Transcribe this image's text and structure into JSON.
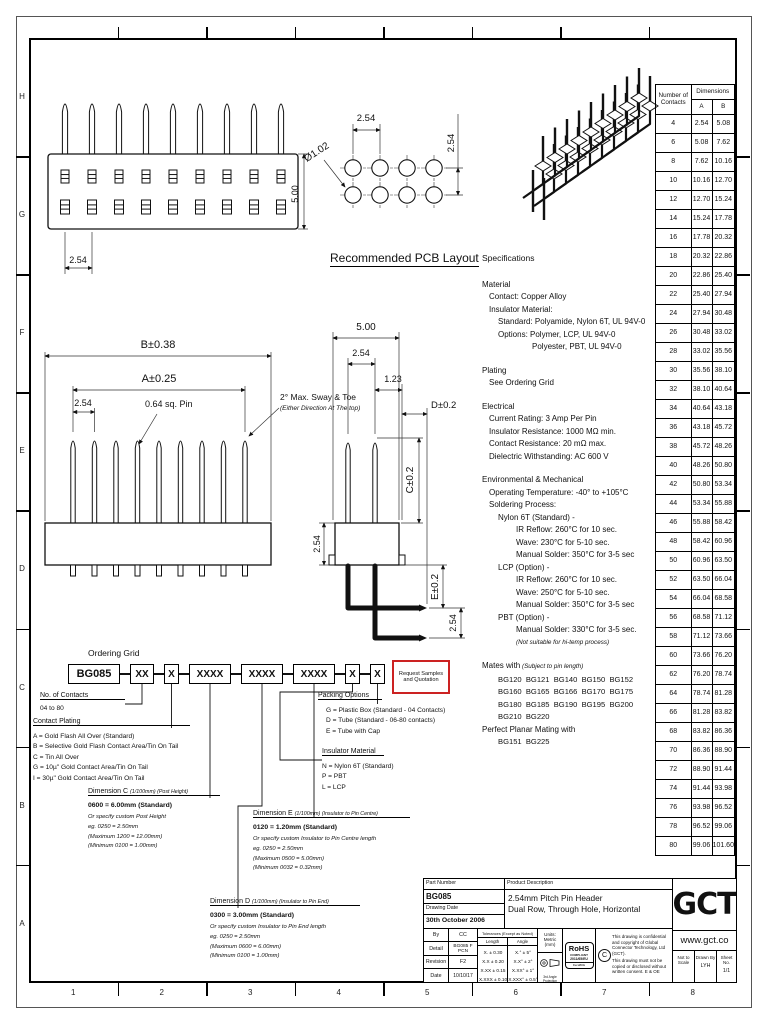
{
  "colors": {
    "paper": "#ffffff",
    "ink": "#111111",
    "accent_red": "#cc2222"
  },
  "sheet_frame": {
    "row_labels": [
      "H",
      "G",
      "F",
      "E",
      "D",
      "C",
      "B",
      "A"
    ],
    "col_labels": [
      "1",
      "2",
      "3",
      "4",
      "5",
      "6",
      "7",
      "8"
    ]
  },
  "front_view": {
    "pitch": "2.54",
    "height": "5.00"
  },
  "pcb_layout": {
    "title": "Recommended PCB Layout",
    "pitch_h": "2.54",
    "pitch_v": "2.54",
    "hole_dia": "Ø1.02"
  },
  "side_view": {
    "dim_b": "B±0.38",
    "dim_a": "A±0.25",
    "pitch": "2.54",
    "pin_label": "0.64 sq. Pin",
    "sway_line1": "2° Max. Sway & Toe",
    "sway_line2": "(Either Direction At The top)",
    "dim_500": "5.00",
    "dim_254_top": "2.54",
    "dim_123": "1.23",
    "dim_d": "D±0.2",
    "dim_c": "C±0.2",
    "dim_e": "E±0.2",
    "dim_254_left": "2.54",
    "dim_254_bottom": "2.54"
  },
  "contacts_table": {
    "header_contacts": "Number of Contacts",
    "header_dimensions": "Dimensions",
    "col_a": "A",
    "col_b": "B",
    "rows": [
      [
        "4",
        "2.54",
        "5.08"
      ],
      [
        "6",
        "5.08",
        "7.62"
      ],
      [
        "8",
        "7.62",
        "10.16"
      ],
      [
        "10",
        "10.16",
        "12.70"
      ],
      [
        "12",
        "12.70",
        "15.24"
      ],
      [
        "14",
        "15.24",
        "17.78"
      ],
      [
        "16",
        "17.78",
        "20.32"
      ],
      [
        "18",
        "20.32",
        "22.86"
      ],
      [
        "20",
        "22.86",
        "25.40"
      ],
      [
        "22",
        "25.40",
        "27.94"
      ],
      [
        "24",
        "27.94",
        "30.48"
      ],
      [
        "26",
        "30.48",
        "33.02"
      ],
      [
        "28",
        "33.02",
        "35.56"
      ],
      [
        "30",
        "35.56",
        "38.10"
      ],
      [
        "32",
        "38.10",
        "40.64"
      ],
      [
        "34",
        "40.64",
        "43.18"
      ],
      [
        "36",
        "43.18",
        "45.72"
      ],
      [
        "38",
        "45.72",
        "48.26"
      ],
      [
        "40",
        "48.26",
        "50.80"
      ],
      [
        "42",
        "50.80",
        "53.34"
      ],
      [
        "44",
        "53.34",
        "55.88"
      ],
      [
        "46",
        "55.88",
        "58.42"
      ],
      [
        "48",
        "58.42",
        "60.96"
      ],
      [
        "50",
        "60.96",
        "63.50"
      ],
      [
        "52",
        "63.50",
        "66.04"
      ],
      [
        "54",
        "66.04",
        "68.58"
      ],
      [
        "56",
        "68.58",
        "71.12"
      ],
      [
        "58",
        "71.12",
        "73.66"
      ],
      [
        "60",
        "73.66",
        "76.20"
      ],
      [
        "62",
        "76.20",
        "78.74"
      ],
      [
        "64",
        "78.74",
        "81.28"
      ],
      [
        "66",
        "81.28",
        "83.82"
      ],
      [
        "68",
        "83.82",
        "86.36"
      ],
      [
        "70",
        "86.36",
        "88.90"
      ],
      [
        "72",
        "88.90",
        "91.44"
      ],
      [
        "74",
        "91.44",
        "93.98"
      ],
      [
        "76",
        "93.98",
        "96.52"
      ],
      [
        "78",
        "96.52",
        "99.06"
      ],
      [
        "80",
        "99.06",
        "101.60"
      ]
    ]
  },
  "specifications": {
    "title": "Specifications",
    "lines": [
      {
        "t": "Material",
        "i": 0
      },
      {
        "t": "Contact: Copper Alloy",
        "i": 1
      },
      {
        "t": "Insulator Material:",
        "i": 1
      },
      {
        "t": "Standard: Polyamide, Nylon 6T, UL 94V-0",
        "i": 2
      },
      {
        "t": "Options: Polymer, LCP, UL 94V-0",
        "i": 2
      },
      {
        "t": "Polyester, PBT, UL 94V-0",
        "i": 4
      },
      {
        "gap": true
      },
      {
        "t": "Plating",
        "i": 0
      },
      {
        "t": "See Ordering Grid",
        "i": 1
      },
      {
        "gap": true
      },
      {
        "t": "Electrical",
        "i": 0
      },
      {
        "t": "Current Rating: 3 Amp Per Pin",
        "i": 1
      },
      {
        "t": "Insulator Resistance: 1000 MΩ min.",
        "i": 1
      },
      {
        "t": "Contact Resistance: 20 mΩ max.",
        "i": 1
      },
      {
        "t": "Dielectric Withstanding: AC 600 V",
        "i": 1
      },
      {
        "gap": true
      },
      {
        "t": "Environmental & Mechanical",
        "i": 0
      },
      {
        "t": "Operating Temperature: -40° to +105°C",
        "i": 1
      },
      {
        "t": "Soldering Process:",
        "i": 1
      },
      {
        "t": "Nylon 6T (Standard) -",
        "i": 2
      },
      {
        "t": "IR Reflow: 260°C for 10 sec.",
        "i": 3
      },
      {
        "t": "Wave: 230°C for 5-10 sec.",
        "i": 3
      },
      {
        "t": "Manual Solder: 350°C for 3-5 sec",
        "i": 3
      },
      {
        "t": "LCP (Option) -",
        "i": 2
      },
      {
        "t": "IR Reflow: 260°C for 10 sec.",
        "i": 3
      },
      {
        "t": "Wave: 250°C for 5-10 sec.",
        "i": 3
      },
      {
        "t": "Manual Solder: 350°C for 3-5 sec",
        "i": 3
      },
      {
        "t": "PBT (Option) -",
        "i": 2
      },
      {
        "t": "Manual Solder: 330°C for 3-5 sec.",
        "i": 3
      },
      {
        "t": "(Not suitable for hi-temp process)",
        "i": 3,
        "s": 1
      },
      {
        "gap": true
      },
      {
        "t": "Mates with",
        "i": 0,
        "t2": "(Subject to pin length)"
      },
      {
        "t": "BG120  BG121  BG140  BG150  BG152",
        "i": 2,
        "pre": 1
      },
      {
        "t": "BG160  BG165  BG166  BG170  BG175",
        "i": 2,
        "pre": 1
      },
      {
        "t": "BG180  BG185  BG190  BG195  BG200",
        "i": 2,
        "pre": 1
      },
      {
        "t": "BG210  BG220",
        "i": 2,
        "pre": 1
      },
      {
        "t": "Perfect Planar Mating with",
        "i": 0
      },
      {
        "t": "BG151  BG225",
        "i": 2,
        "pre": 1
      }
    ]
  },
  "ordering": {
    "title": "Ordering Grid",
    "boxes": [
      "BG085",
      "XX",
      "X",
      "XXXX",
      "XXXX",
      "XXXX",
      "X",
      "X"
    ],
    "request_box": {
      "line1": "Request Samples",
      "line2": "and Quotation"
    },
    "contacts": {
      "header": "No. of Contacts",
      "range": "04 to 80"
    },
    "plating": {
      "header": "Contact Plating",
      "items": [
        "A = Gold Flash All Over (Standard)",
        "B = Selective Gold Flash Contact Area/Tin On Tail",
        "C = Tin All Over",
        "G = 10µ\" Gold Contact Area/Tin On Tail",
        "I = 30µ\" Gold Contact Area/Tin On Tail"
      ]
    },
    "dim_c": {
      "header": "Dimension C",
      "note": "(1/100mm) (Post Height)",
      "standard": "0600 = 6.00mm (Standard)",
      "notes": [
        "Or specify custom Post Height",
        "eg. 0250 = 2.50mm",
        "(Maximum 1200 = 12.00mm)",
        "(Minimum 0100 = 1.00mm)"
      ]
    },
    "dim_d": {
      "header": "Dimension D",
      "note": "(1/100mm) (Insulator to Pin End)",
      "standard": "0300 = 3.00mm (Standard)",
      "notes": [
        "Or specify custom Insulator to Pin End length",
        "eg. 0250 = 2.50mm",
        "(Maximum 0600 = 6.00mm)",
        "(Minimum 0100 = 1.00mm)"
      ]
    },
    "dim_e": {
      "header": "Dimension E",
      "note": "(1/100mm) (Insulator to Pin Centre)",
      "standard": "0120 = 1.20mm (Standard)",
      "notes": [
        "Or specify custom Insulator to Pin Centre length",
        "eg. 0250 = 2.50mm",
        "(Maximum 0500 = 5.00mm)",
        "(Minimum 0032 = 0.32mm)"
      ]
    },
    "insulator": {
      "header": "Insulator Material",
      "items": [
        "N = Nylon 6T (Standard)",
        "P = PBT",
        "L = LCP"
      ]
    },
    "packing": {
      "header": "Packing Options",
      "items": [
        "G = Plastic Box (Standard - 04 Contacts)",
        "D = Tube (Standard - 06-80 contacts)",
        "E = Tube with Cap"
      ]
    }
  },
  "title_block": {
    "part_number_label": "Part Number",
    "part_number": "BG085",
    "drawing_date_label": "Drawing Date",
    "drawing_date": "30th October 2006",
    "product_description_label": "Product Description",
    "product_description_1": "2.54mm Pitch Pin Header",
    "product_description_2": "Dual Row, Through Hole, Horizontal",
    "by_label": "By",
    "by": "CC",
    "detail_label": "Detail",
    "detail": "BG085 F PCN",
    "revision_label": "Revision",
    "revision": "F2",
    "date_label": "Date",
    "date": "10/10/17",
    "tolerances_label": "Tolerances (Except as Noted)",
    "length_label": "Length",
    "angle_label": "Angle",
    "length_tols": [
      "X. ± 0.30",
      "X.X ± 0.20",
      "X.XX ± 0.15",
      "X.XXX ± 0.10"
    ],
    "angle_tols": [
      "X.° ± 5°",
      "X.X° ± 2°",
      "X.XX° ± 1°",
      "X.XXX° ± 0.5°"
    ],
    "units_label": "Units:",
    "units": "Metric (mm)",
    "projection_label": "3rd Angle Projection",
    "rohs": {
      "line1": "RoHS",
      "line2": "COMPLIANT",
      "line3": "2011/65/EU",
      "line4": "DecaBDE"
    },
    "copyright_1": "This drawing is confidential and copyright of Global Connector Technology, Ltd (GCT).",
    "copyright_2": "This drawing must not be copied or disclosed without written consent. E & OE",
    "logo": "GCT",
    "website": "www.gct.co",
    "scale_1": "Not to",
    "scale_2": "Scale",
    "drawn_by_label": "Drawn By",
    "drawn_by": "LYH",
    "sheet_label": "Sheet No.",
    "sheet": "1/1"
  }
}
